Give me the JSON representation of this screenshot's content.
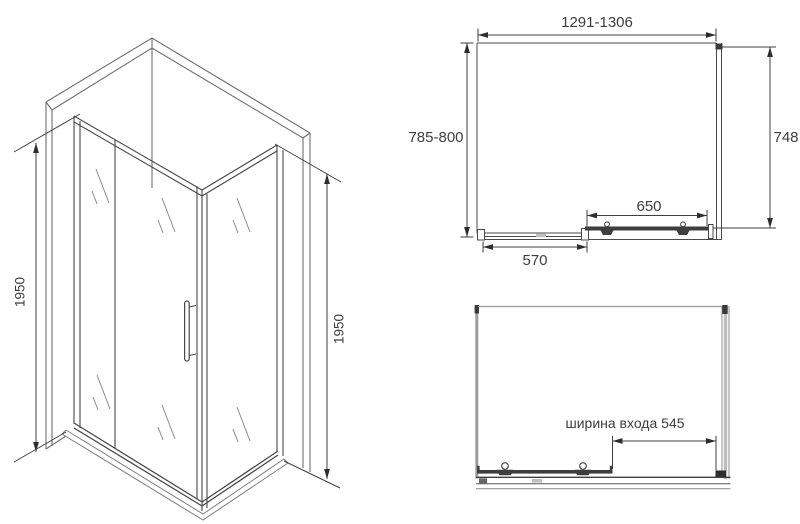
{
  "figure": {
    "type": "technical-drawing",
    "subject": "corner shower enclosure with sliding door",
    "colors": {
      "line": "#4a4a4a",
      "wall": "#9c9c9c",
      "text": "#3d3d3d",
      "background": "#ffffff"
    }
  },
  "isometric_view": {
    "left_height_label": "1950",
    "right_height_label": "1950"
  },
  "plan_view": {
    "width_label": "1291-1306",
    "depth_label": "785-800",
    "side_panel_label": "748",
    "door_label": "650",
    "fixed_panel_label": "570"
  },
  "entrance_view": {
    "entrance_width_label": "ширина входа 545"
  }
}
